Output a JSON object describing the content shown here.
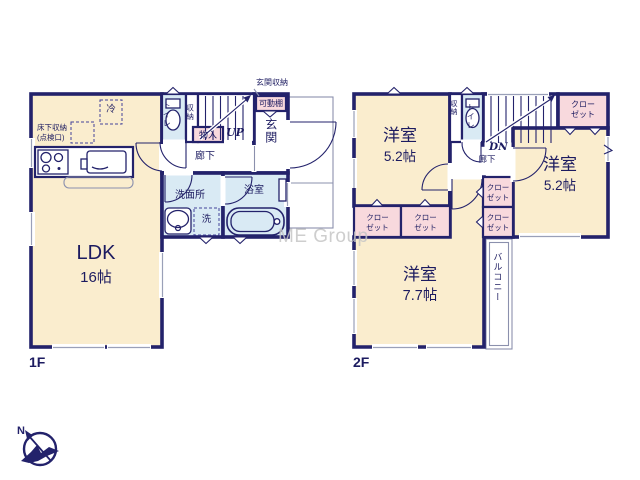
{
  "watermark": "ME Group",
  "compass": {
    "north": "N"
  },
  "colors": {
    "wall": "#23226B",
    "room": "#FAEDCE",
    "wet_area": "#D9EAF4",
    "closet": "#F8D9DD",
    "ink": "#1c1b60"
  },
  "floor1": {
    "label": "1F",
    "ldk": {
      "name": "LDK",
      "size": "16帖"
    },
    "fridge": "冷",
    "underfloor_storage": [
      "床下収納",
      "(点検口)"
    ],
    "toilet": "トイレ",
    "storage": "収納",
    "closet": "物入",
    "stairs_direction": "UP",
    "hallway": "廊下",
    "entrance": "玄関",
    "entrance_storage": "玄関収納",
    "movable_shelf": "可動棚",
    "washroom": "洗面所",
    "washer": "洗",
    "bathroom": "浴室"
  },
  "floor2": {
    "label": "2F",
    "rooms": [
      {
        "name": "洋室",
        "size": "5.2帖"
      },
      {
        "name": "洋室",
        "size": "5.2帖"
      },
      {
        "name": "洋室",
        "size": "7.7帖"
      }
    ],
    "closet_line1": "クロー",
    "closet_line2": "ゼット",
    "storage": "収納",
    "toilet": "トイレ",
    "stairs_direction": "DN",
    "hallway": "廊下",
    "balcony": "バルコニー"
  }
}
